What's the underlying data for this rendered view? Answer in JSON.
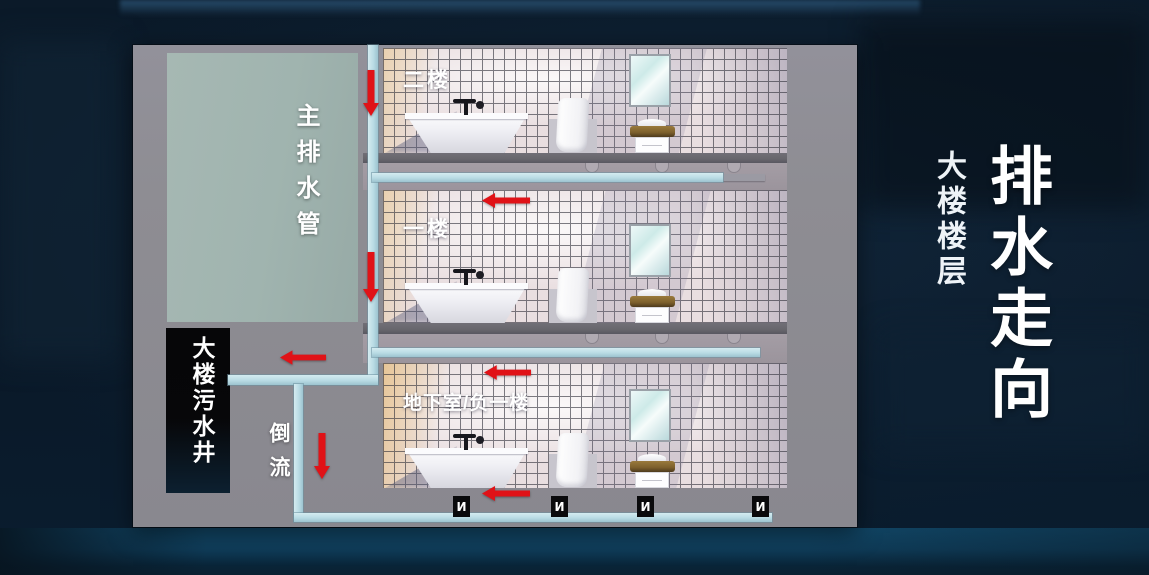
{
  "theme": {
    "accent_red": "#e01217",
    "pipe_blue": "#b9dbe4",
    "panel_concrete": "#8e8d93",
    "duct_green": "#a0b4af",
    "well_black": "#070709",
    "bg_navy": "#0b1a29",
    "slab_gray": "#67666c",
    "tile_pink": "#e9dee0"
  },
  "side_panel": {
    "subtitle": "大楼楼层",
    "title": "排水走向"
  },
  "diagram": {
    "main_pipe_label": "主排水管",
    "sewage_well_label": "大楼污水井",
    "backflow_label": "倒流",
    "floors": [
      {
        "label": "二楼"
      },
      {
        "label": "一楼"
      },
      {
        "label": "地下室/负一楼"
      }
    ],
    "trap_icon_glyph": "И",
    "flow_arrows": [
      {
        "id": "main-pipe-floor2",
        "direction": "down"
      },
      {
        "id": "main-pipe-floor1",
        "direction": "down"
      },
      {
        "id": "floor1-branch",
        "direction": "left"
      },
      {
        "id": "basement-branch",
        "direction": "left"
      },
      {
        "id": "to-sewage-well",
        "direction": "left"
      },
      {
        "id": "backflow-pipe",
        "direction": "down"
      },
      {
        "id": "basement-floor",
        "direction": "left"
      }
    ]
  }
}
